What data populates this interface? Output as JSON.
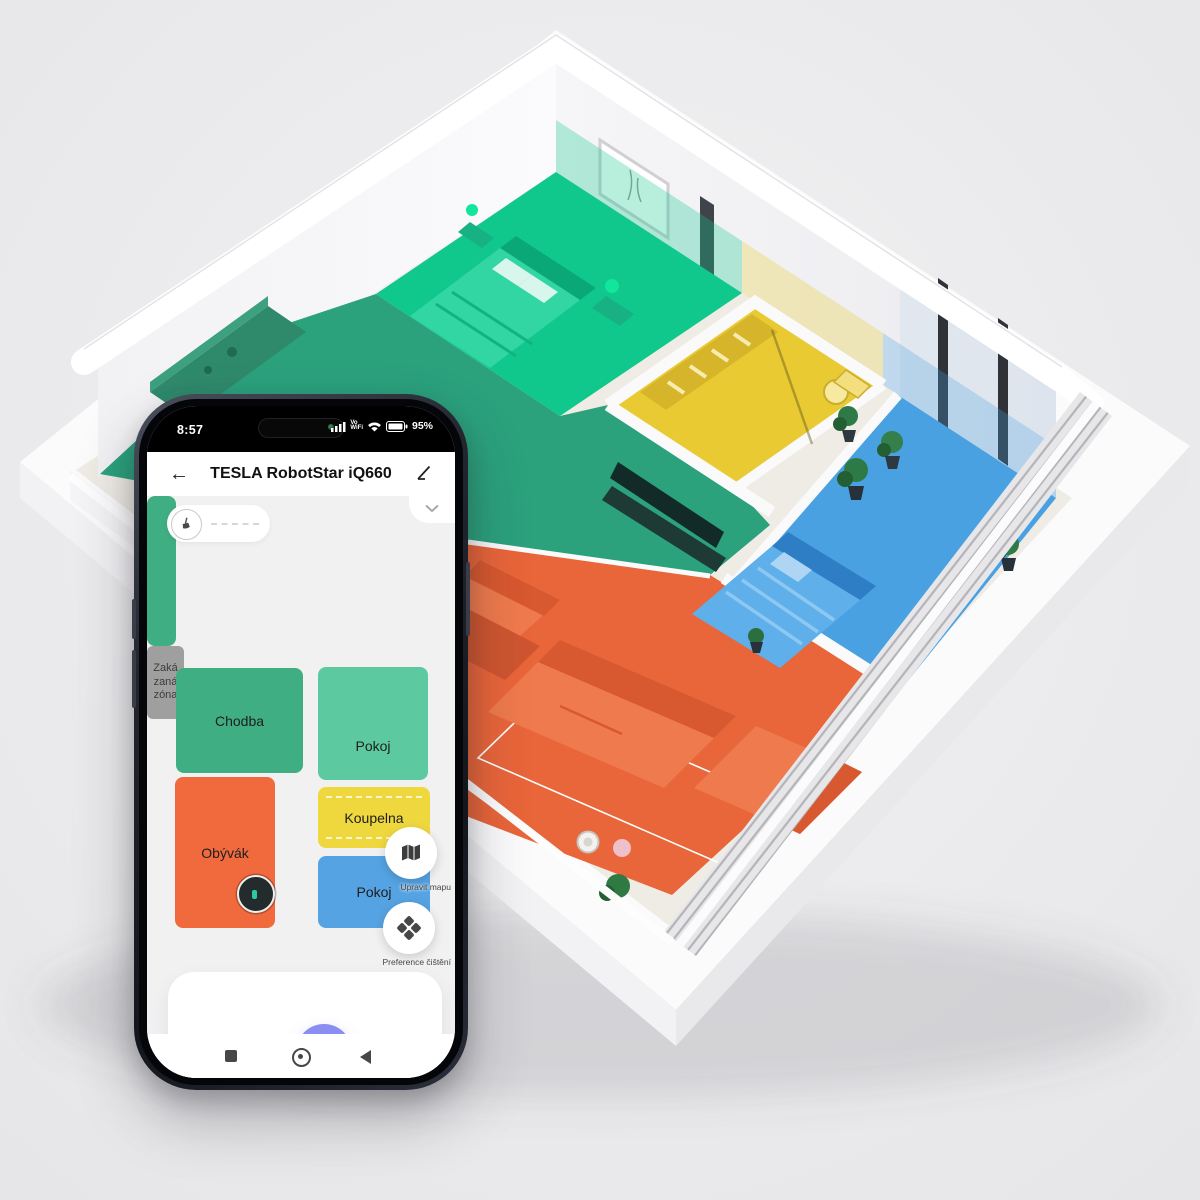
{
  "app": {
    "status_bar": {
      "time": "8:57",
      "battery": "95%"
    },
    "header": {
      "title": "TESLA RobotStar iQ660"
    },
    "map": {
      "rooms": [
        {
          "label": "Chodba",
          "color": "#3fae82"
        },
        {
          "label": "Pokoj",
          "color": "#5dc9a1"
        },
        {
          "label": "Koupelna",
          "color": "#efd83e"
        },
        {
          "label": "Pokoj",
          "color": "#55a3e3"
        },
        {
          "label": "Obývák",
          "color": "#f16a3d"
        }
      ],
      "no_go_zone": {
        "lines": [
          "Zaká",
          "zaná",
          "zóna"
        ],
        "color": "#9f9f9f"
      }
    },
    "floating_actions": [
      {
        "label": "Upravit mapu"
      },
      {
        "label": "Preference čištění"
      }
    ],
    "controls": {
      "accent": "#8a8ef2"
    }
  },
  "scene": {
    "type": "isometric-apartment-render",
    "zones": [
      {
        "name": "bedroom-top",
        "color": "#10c78c"
      },
      {
        "name": "hall-kitchen",
        "color": "#2ba17c"
      },
      {
        "name": "bathroom",
        "color": "#e9ca33"
      },
      {
        "name": "bedroom-right",
        "color": "#4aa1e2"
      },
      {
        "name": "living-room",
        "color": "#e9653a"
      }
    ]
  }
}
